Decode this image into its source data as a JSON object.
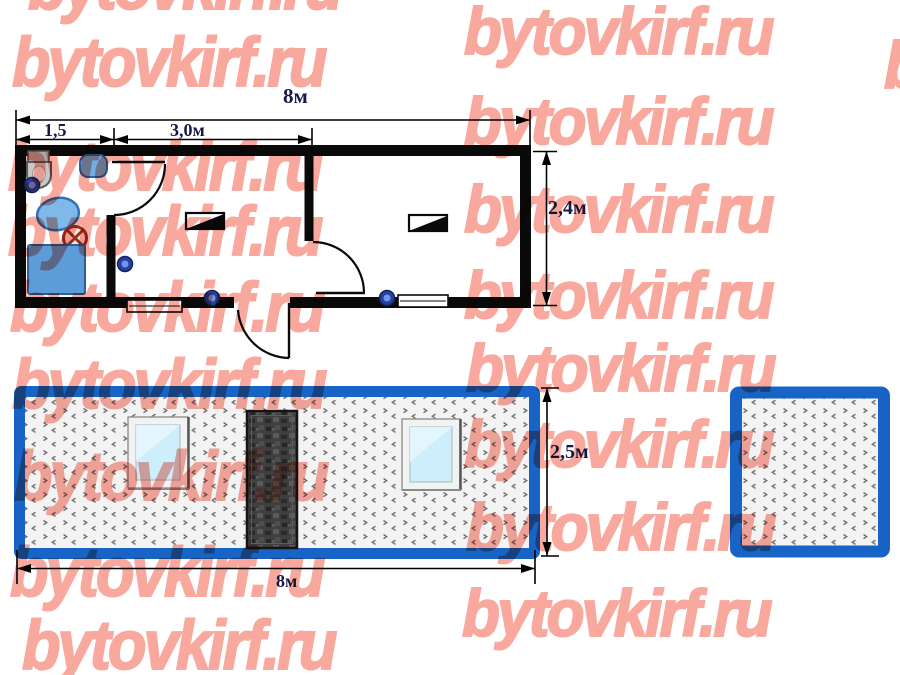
{
  "watermark": {
    "text": "bytovkirf.ru",
    "color": "#f9a89e"
  },
  "plan": {
    "dim_width_total": "8м",
    "dim_seg_left": "1,5",
    "dim_seg_middle": "3,0м",
    "dim_depth": "2,4м",
    "fixture_icons": [
      "toilet-icon",
      "sink-icon",
      "washbasin-icon",
      "shower-cabin-icon",
      "ceiling-lamp-icon",
      "wall-lamp-icon",
      "heater-icon",
      "door-swing-icon",
      "window-icon"
    ]
  },
  "elevation_front": {
    "dim_height": "2,5м",
    "dim_width": "8м"
  },
  "colors": {
    "frame_blue": "#1863c6",
    "dim_text": "#16184a",
    "wall_black": "#0a0a0a",
    "fixture_blue": "#5d9bd9",
    "glass_blue": "#cdeefb",
    "door_dark": "#3f3f3f"
  }
}
